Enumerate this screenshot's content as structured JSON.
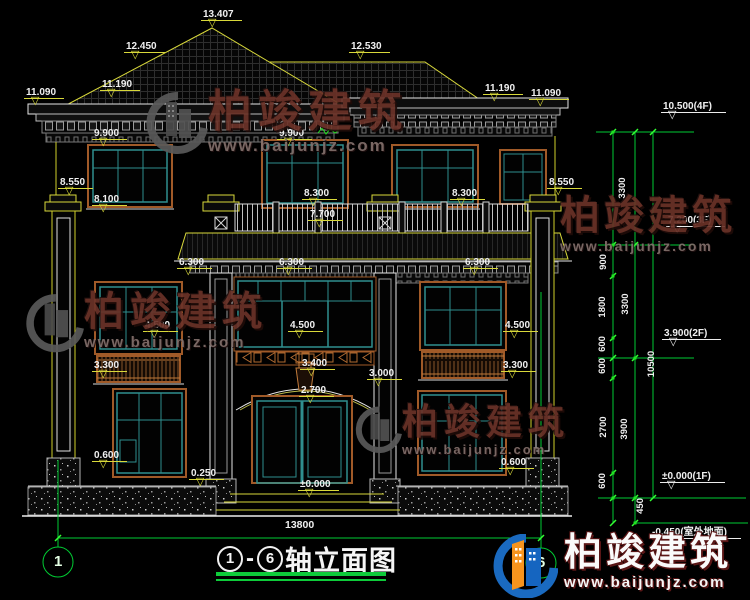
{
  "colors": {
    "background": "#000000",
    "cad_yellow": "#d9d93a",
    "cad_green": "#00cc33",
    "cad_white": "#ececec",
    "window_teal": "#2f8f8f",
    "frame_brown": "#a05a28",
    "watermark_red": "#6b3228",
    "logo_blue": "#1a6ac0",
    "logo_orange": "#f7941d"
  },
  "glyphs": {
    "flag_triangle": "▽"
  },
  "watermark": {
    "brand": "柏竣建筑",
    "url": "www.baijunjz.com"
  },
  "footer_logo": {
    "brand": "柏竣建筑",
    "url": "www.baijunjz.com"
  },
  "title": {
    "axis_start": "1",
    "separator": "-",
    "axis_end": "6",
    "label": "轴立面图"
  },
  "annotations": [
    {
      "text": "13.407",
      "x": 203,
      "y": 9,
      "type": "ydim"
    },
    {
      "text": "12.450",
      "x": 126,
      "y": 41,
      "type": "ydim"
    },
    {
      "text": "12.530",
      "x": 351,
      "y": 41,
      "type": "ydim"
    },
    {
      "text": "11.090",
      "x": 26,
      "y": 87,
      "type": "ydim"
    },
    {
      "text": "11.190",
      "x": 102,
      "y": 79,
      "type": "ydim"
    },
    {
      "text": "11.190",
      "x": 485,
      "y": 83,
      "type": "ydim"
    },
    {
      "text": "11.090",
      "x": 531,
      "y": 88,
      "type": "ydim"
    },
    {
      "text": "9.900",
      "x": 94,
      "y": 128,
      "type": "ydim"
    },
    {
      "text": "9.900",
      "x": 279,
      "y": 128,
      "type": "ydim"
    },
    {
      "text": "8.550",
      "x": 60,
      "y": 177,
      "type": "ydim"
    },
    {
      "text": "8.100",
      "x": 94,
      "y": 194,
      "type": "ydim"
    },
    {
      "text": "8.300",
      "x": 304,
      "y": 188,
      "type": "ydim"
    },
    {
      "text": "8.300",
      "x": 452,
      "y": 188,
      "type": "ydim"
    },
    {
      "text": "8.550",
      "x": 549,
      "y": 177,
      "type": "ydim"
    },
    {
      "text": "7.700",
      "x": 310,
      "y": 209,
      "type": "ydim"
    },
    {
      "text": "6.300",
      "x": 179,
      "y": 257,
      "type": "ydim"
    },
    {
      "text": "6.300",
      "x": 279,
      "y": 257,
      "type": "ydim"
    },
    {
      "text": "6.300",
      "x": 465,
      "y": 257,
      "type": "ydim"
    },
    {
      "text": "4.500",
      "x": 145,
      "y": 320,
      "type": "ydim"
    },
    {
      "text": "4.500",
      "x": 290,
      "y": 320,
      "type": "ydim"
    },
    {
      "text": "4.500",
      "x": 505,
      "y": 320,
      "type": "ydim"
    },
    {
      "text": "3.300",
      "x": 94,
      "y": 360,
      "type": "ydim"
    },
    {
      "text": "3.400",
      "x": 302,
      "y": 358,
      "type": "ydim"
    },
    {
      "text": "3.300",
      "x": 503,
      "y": 360,
      "type": "ydim"
    },
    {
      "text": "3.000",
      "x": 369,
      "y": 368,
      "type": "ydim"
    },
    {
      "text": "2.700",
      "x": 301,
      "y": 385,
      "type": "ydim"
    },
    {
      "text": "0.600",
      "x": 94,
      "y": 450,
      "type": "ydim"
    },
    {
      "text": "0.600",
      "x": 501,
      "y": 457,
      "type": "ydim"
    },
    {
      "text": "0.250",
      "x": 191,
      "y": 468,
      "type": "ydim"
    },
    {
      "text": "±0.000",
      "x": 300,
      "y": 479,
      "type": "ydim"
    },
    {
      "text": "13800",
      "x": 285,
      "y": 520,
      "type": "plain"
    },
    {
      "text": "3300",
      "x": 623,
      "y": 188,
      "type": "vdim"
    },
    {
      "text": "900",
      "x": 604,
      "y": 262,
      "type": "vdim"
    },
    {
      "text": "1800",
      "x": 603,
      "y": 307,
      "type": "vdim"
    },
    {
      "text": "3300",
      "x": 626,
      "y": 304,
      "type": "vdim"
    },
    {
      "text": "600",
      "x": 603,
      "y": 344,
      "type": "vdim"
    },
    {
      "text": "600",
      "x": 603,
      "y": 366,
      "type": "vdim"
    },
    {
      "text": "2700",
      "x": 604,
      "y": 427,
      "type": "vdim"
    },
    {
      "text": "3900",
      "x": 625,
      "y": 429,
      "type": "vdim"
    },
    {
      "text": "600",
      "x": 603,
      "y": 481,
      "type": "vdim"
    },
    {
      "text": "10500",
      "x": 652,
      "y": 364,
      "type": "vdim"
    },
    {
      "text": "450",
      "x": 641,
      "y": 506,
      "type": "vdim"
    },
    {
      "text": "10.500(4F)",
      "x": 663,
      "y": 101,
      "type": "elev"
    },
    {
      "text": "7.200(3F)",
      "x": 668,
      "y": 215,
      "type": "elev"
    },
    {
      "text": "3.900(2F)",
      "x": 664,
      "y": 328,
      "type": "elev"
    },
    {
      "text": "±0.000(1F)",
      "x": 662,
      "y": 471,
      "type": "elev"
    },
    {
      "text": "-0.450(室外地面)",
      "x": 652,
      "y": 527,
      "type": "elev"
    },
    {
      "text": "1",
      "x": 54,
      "y": 554,
      "type": "axis"
    },
    {
      "text": "6",
      "x": 537,
      "y": 555,
      "type": "axis"
    }
  ]
}
